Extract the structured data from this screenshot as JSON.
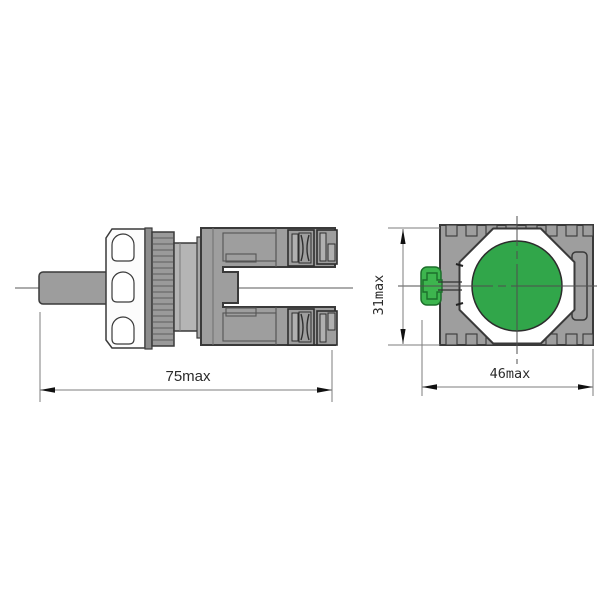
{
  "views": {
    "side": {
      "dimension": {
        "label": "75max"
      }
    },
    "front": {
      "width_dimension": {
        "label": "46max"
      },
      "height_dimension": {
        "label": "31max"
      }
    }
  },
  "colors": {
    "button_green": "#31a64a",
    "tab_green": "#3db54e",
    "tab_border": "#1d6f2b",
    "body_gray": "#9e9e9e",
    "light_gray": "#b5b5b5",
    "outline": "#3a3a3a"
  }
}
